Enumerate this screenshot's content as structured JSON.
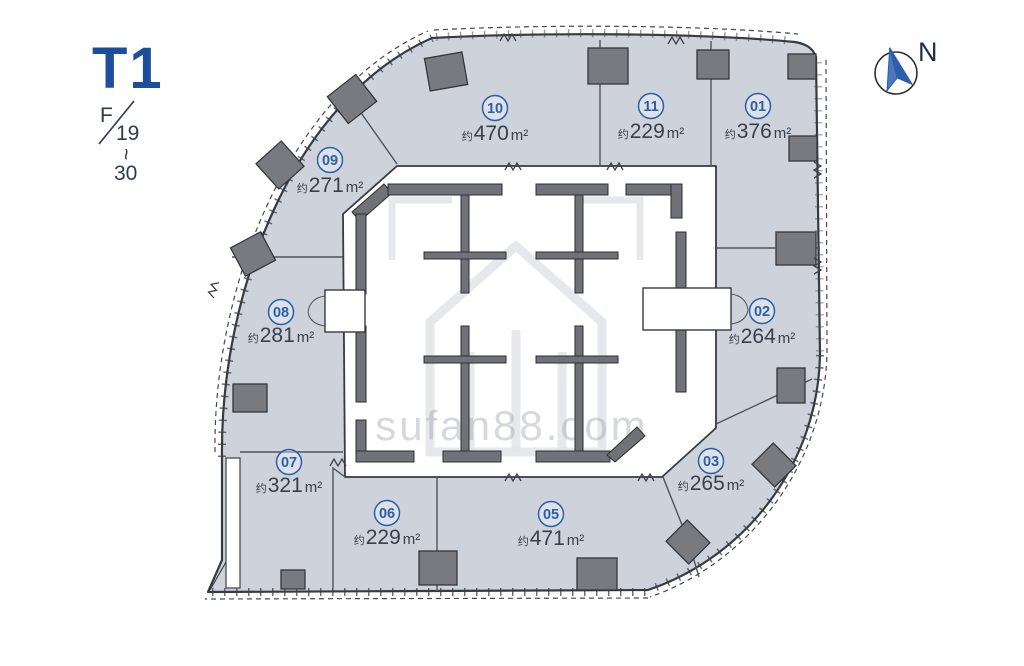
{
  "plan": {
    "tower": "T1",
    "floor_label": {
      "prefix": "F",
      "from": "19",
      "tilde": "~",
      "to": "30"
    },
    "compass_label": "N",
    "watermark_text": "sufan88.com",
    "units": [
      {
        "no": "01",
        "approx": "约",
        "value": "376",
        "unit": "m²"
      },
      {
        "no": "02",
        "approx": "约",
        "value": "264",
        "unit": "m²"
      },
      {
        "no": "03",
        "approx": "约",
        "value": "265",
        "unit": "m²"
      },
      {
        "no": "05",
        "approx": "约",
        "value": "471",
        "unit": "m²"
      },
      {
        "no": "06",
        "approx": "约",
        "value": "229",
        "unit": "m²"
      },
      {
        "no": "07",
        "approx": "约",
        "value": "321",
        "unit": "m²"
      },
      {
        "no": "08",
        "approx": "约",
        "value": "281",
        "unit": "m²"
      },
      {
        "no": "09",
        "approx": "约",
        "value": "271",
        "unit": "m²"
      },
      {
        "no": "10",
        "approx": "约",
        "value": "470",
        "unit": "m²"
      },
      {
        "no": "11",
        "approx": "约",
        "value": "229",
        "unit": "m²"
      }
    ],
    "colors": {
      "accent_blue": "#2b5fa8",
      "unit_fill": "#cdd2db",
      "wall_gray": "#707277",
      "title_blue": "#1c4e9e"
    }
  }
}
